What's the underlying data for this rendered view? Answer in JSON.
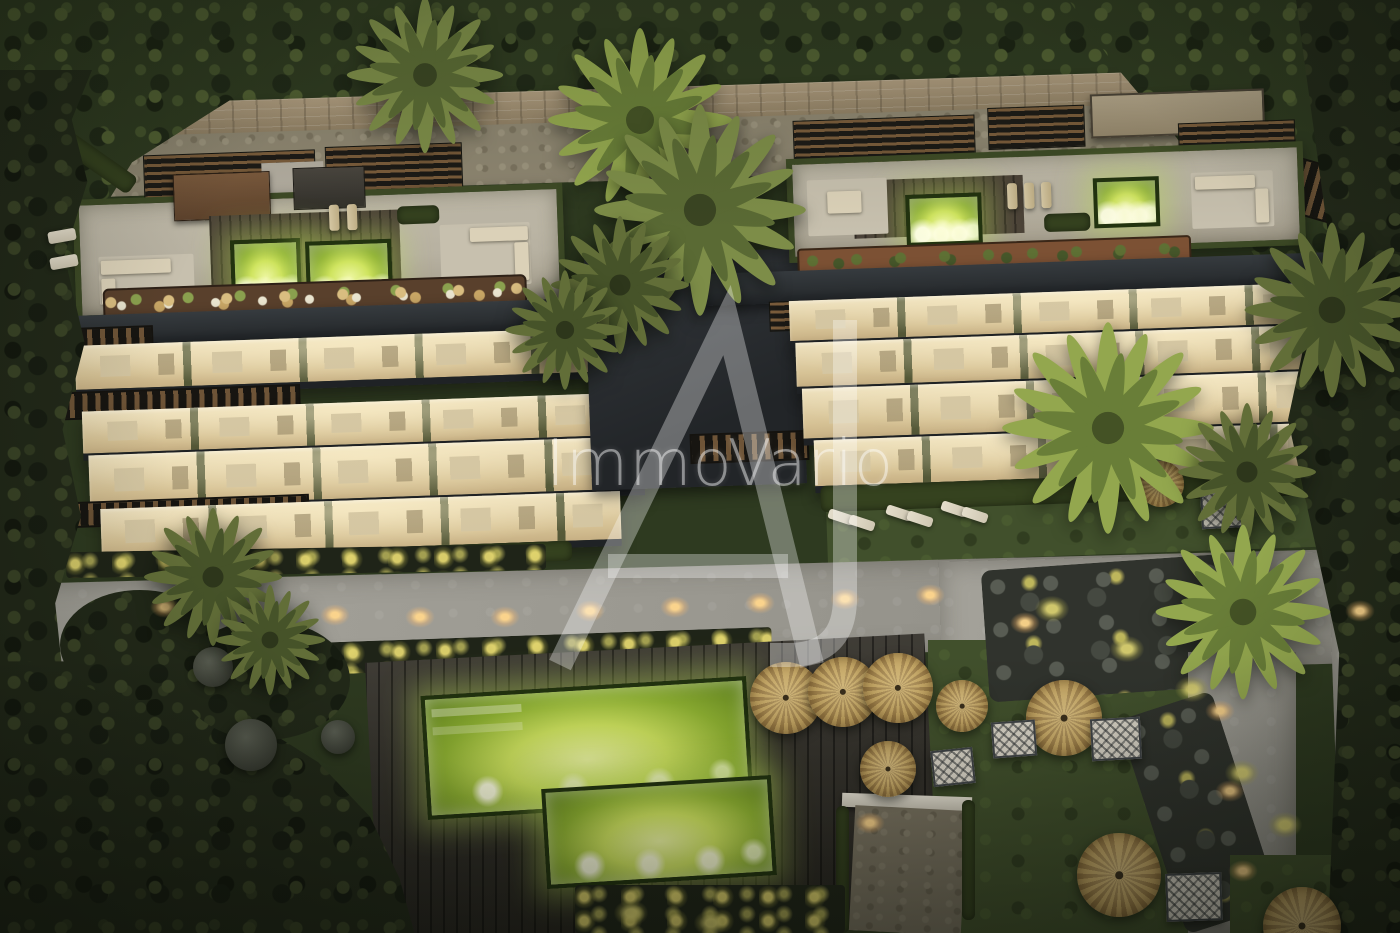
{
  "watermark": {
    "brand": "ImmoVario",
    "monogram": "AJ"
  },
  "palette": {
    "forest_dark": "#1f2817",
    "forest_mid": "#2e3a20",
    "forest_light": "#516032",
    "wall_tan": "#b09d80",
    "gravel": "#8e8671",
    "slab_charcoal": "#2b2f32",
    "concrete_roof": "#b7b1a1",
    "terrace_warm": "#efe2bf",
    "terrace_deep": "#d6c295",
    "hedge_green": "#3d4a26",
    "planter_brown": "#59402c",
    "rust_planter": "#7c5134",
    "pergola_wood": "#7a5c3b",
    "pool_glow": "#cfe45f",
    "pool_deep": "#5d7f1d",
    "deck_wood": "#35322b",
    "path_gray": "#9a9890",
    "grass_olive": "#41502c",
    "umbrella_straw": "#c2a360",
    "cabana_white": "#d9d4c7",
    "light_warm": "#ffd78f",
    "plant_glow": "#d9cf66",
    "watermark_white": "rgba(255,255,255,0.45)"
  }
}
